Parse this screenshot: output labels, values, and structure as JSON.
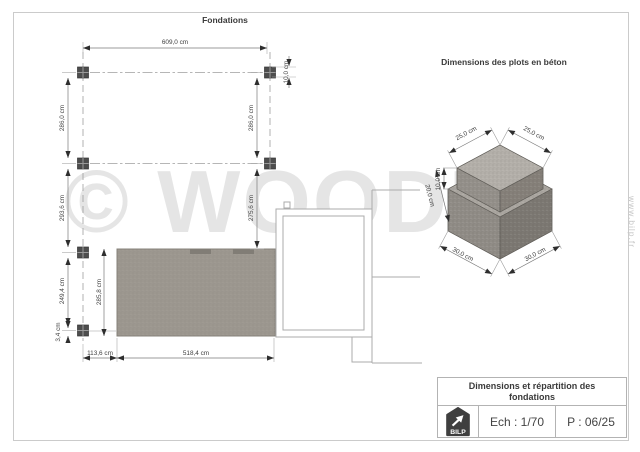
{
  "watermark": {
    "brand": "© WOODIY",
    "site": "www.bilp.fr"
  },
  "plan": {
    "title": "Fondations",
    "dims": {
      "total_width": "609,0 cm",
      "row1_left": "286,0 cm",
      "row1_right": "286,0 cm",
      "plot_size": "10,0 cm",
      "row2_left": "293,6 cm",
      "row2_right": "275,6 cm",
      "row3_left": "249,4 cm",
      "row4_left": "3,4 cm",
      "terrace_depth": "285,8 cm",
      "bottom_offset": "113,6 cm",
      "bottom_width": "518,4 cm"
    }
  },
  "plots3d": {
    "title": "Dimensions des plots en béton",
    "dims": {
      "cap_left": "25,0 cm",
      "cap_right": "25,0 cm",
      "cap_height": "10,0 cm",
      "base_height": "20,0 cm",
      "base_left": "30,0 cm",
      "base_right": "30,0 cm"
    }
  },
  "title_block": {
    "title": "Dimensions et répartition des fondations",
    "scale": "Ech : 1/70",
    "page": "P : 06/25",
    "logo": "BILP"
  }
}
